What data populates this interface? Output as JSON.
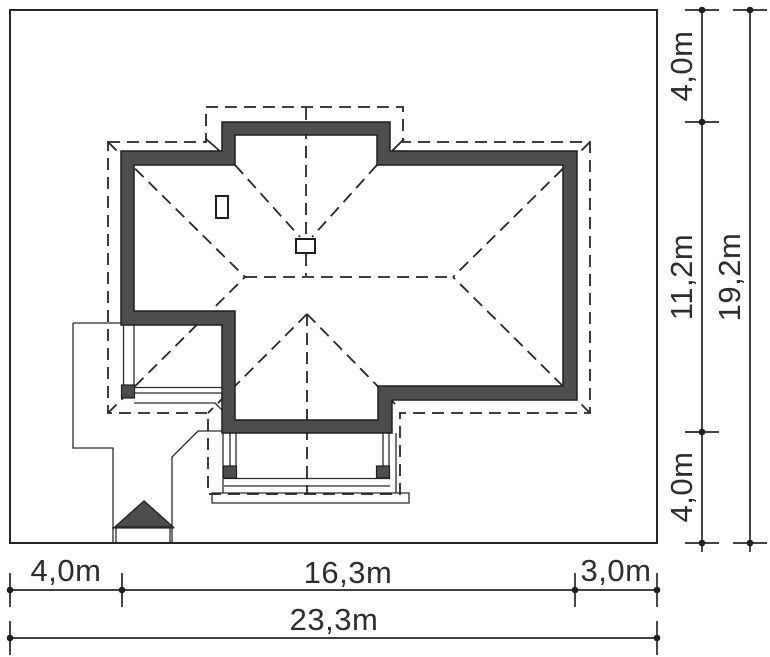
{
  "drawing": {
    "type": "house-site-plan",
    "colors": {
      "wall_fill": "#4d4d4d",
      "line_color": "#262626",
      "text_color": "#2d2d2d",
      "background": "#ffffff"
    }
  },
  "dimensions": {
    "right": {
      "inner_top": "4,0m",
      "inner_middle": "11,2m",
      "inner_bottom": "4,0m",
      "outer_total": "19,2m"
    },
    "bottom": {
      "left": "4,0m",
      "middle": "16,3m",
      "right": "3,0m",
      "total": "23,3m"
    }
  }
}
